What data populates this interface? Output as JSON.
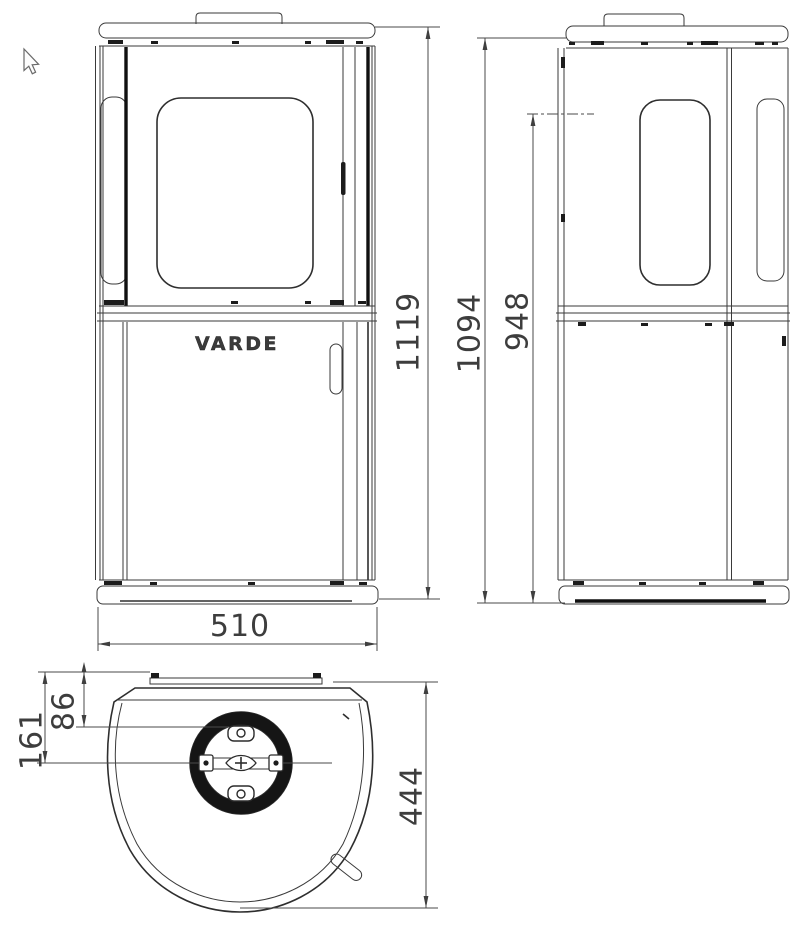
{
  "logo": "VARDE",
  "dimensions": {
    "front_height": "1119",
    "front_width": "510",
    "side_overall_height": "1094",
    "side_rear_height": "948",
    "flue_edge_to_front": "86",
    "flue_center_to_front": "161",
    "depth": "444"
  }
}
